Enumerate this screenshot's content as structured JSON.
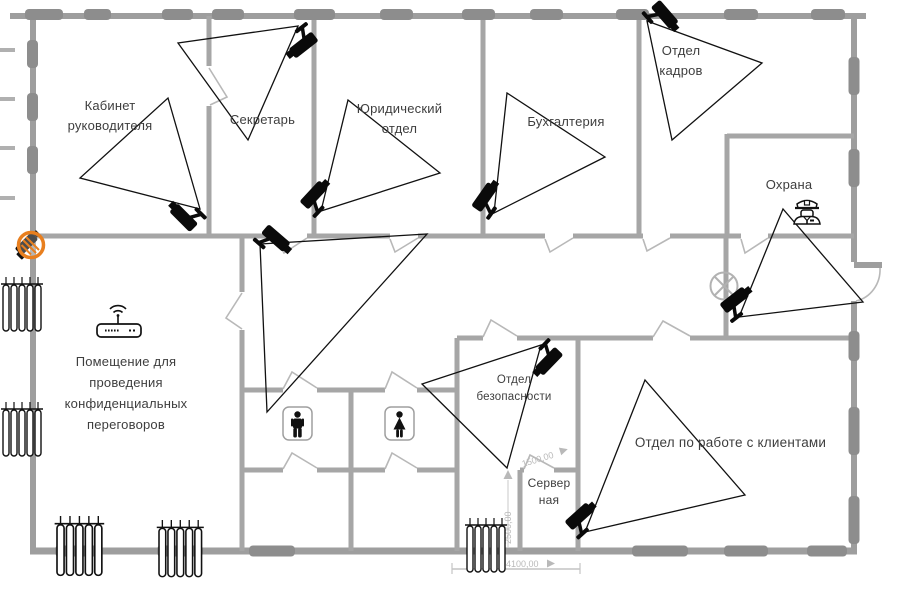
{
  "rooms": {
    "director": {
      "line1": "Кабинет",
      "line2": "руководителя"
    },
    "secretary": {
      "name": "Секретарь"
    },
    "legal": {
      "line1": "Юридический",
      "line2": "отдел"
    },
    "accounting": {
      "name": "Бухгалтерия"
    },
    "hr": {
      "line1": "Отдел",
      "line2": "кадров"
    },
    "guard": {
      "name": "Охрана"
    },
    "confidential": {
      "line1": "Помещение для",
      "line2": "проведения",
      "line3": "конфиденциальных",
      "line4": "переговоров"
    },
    "security": {
      "line1": "Отдел",
      "line2": "безопасности"
    },
    "server": {
      "line1": "Сервер",
      "line2": "ная"
    },
    "clients": {
      "name": "Отдел по работе с клиентами"
    }
  },
  "dimensions": {
    "server_width": "1500,00",
    "corridor_height": "2500,00",
    "bottom_width": "4100,00"
  },
  "counts": {
    "cameras": 9,
    "fov_cones": 9,
    "radiators": 5,
    "wc_stalls": 2
  },
  "icons": {
    "camera": "cctv-camera-icon",
    "camera_prohibited": "no-camera-icon",
    "wifi_router": "wifi-router-icon",
    "guard": "security-guard-icon",
    "wc_male": "male-wc-icon",
    "wc_female": "female-wc-icon",
    "fan": "ceiling-fan-icon",
    "radiator": "radiator-icon"
  },
  "colors": {
    "wall": "#a6a6a6",
    "outer_wall": "#9e9e9e",
    "window_block": "#8d8d8d",
    "door": "#b8b8b8",
    "label_text": "#3e3e3e",
    "dimension": "#b9b9b9",
    "camera": "#0a0a0a",
    "fov_outline": "#111111",
    "prohibition_sign": "#e87f1f"
  }
}
